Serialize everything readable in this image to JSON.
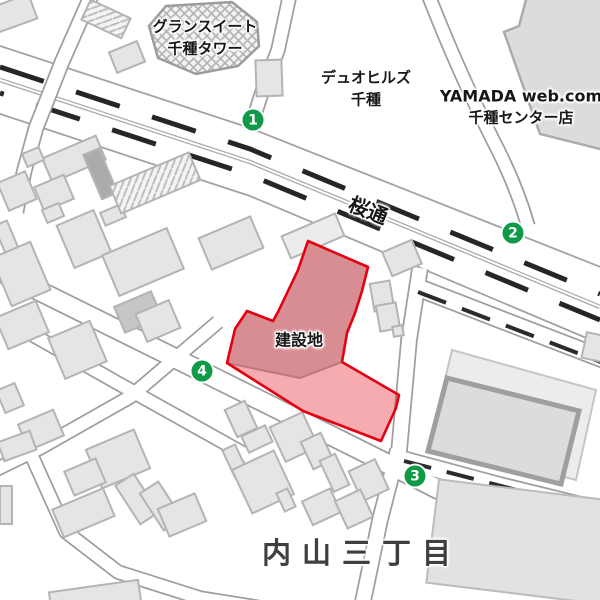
{
  "map": {
    "labels": {
      "grand_suite": {
        "line1": "グランスイート",
        "line2": "千種タワー"
      },
      "duo_hills": {
        "line1": "デュオヒルズ",
        "line2": "千種"
      },
      "yamada": {
        "line1": "YAMADA web.com",
        "line2": "千種センター店"
      },
      "sakura_dori": "桜通",
      "construction_site": "建設地",
      "district": "内山三丁目"
    },
    "markers": [
      {
        "label": "1"
      },
      {
        "label": "2"
      },
      {
        "label": "3"
      },
      {
        "label": "4"
      }
    ],
    "colors": {
      "site_outline": "#e50011",
      "site_fill": "rgba(229,0,17,0.33)",
      "marker_green": "#0f9a48",
      "road_casing": "#9e9e9e",
      "road_fill": "#ffffff",
      "building_fill": "#e5e5e5",
      "building_stroke": "#b4b4b4",
      "median_dash": "#262626",
      "district_text": "#3f3f3f",
      "label_text": "#161616"
    }
  }
}
